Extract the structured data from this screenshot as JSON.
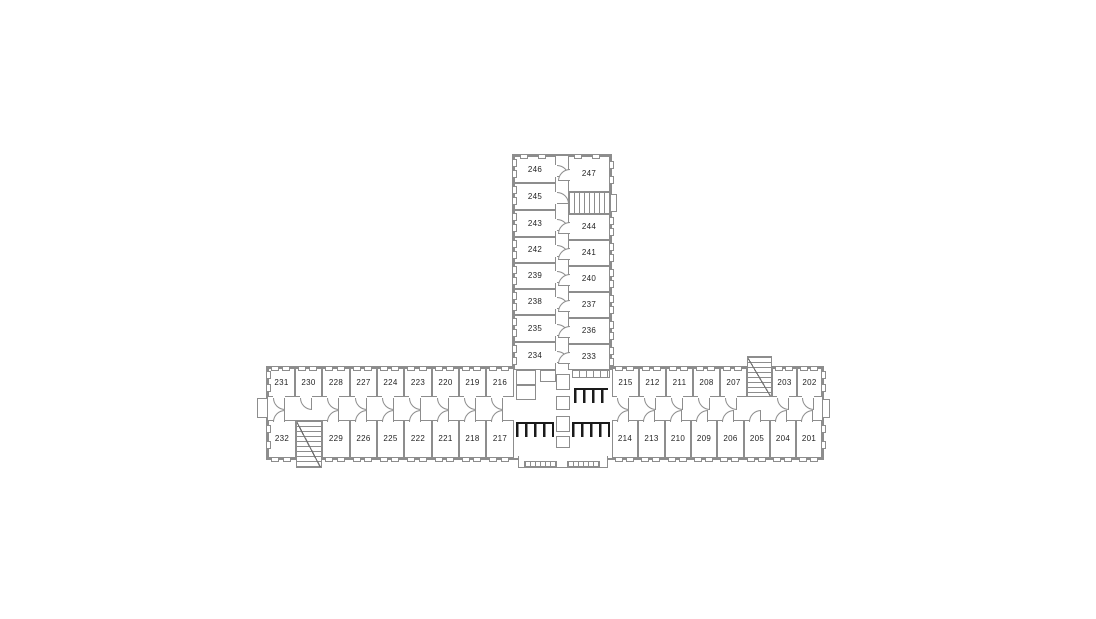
{
  "plan": {
    "canvas": {
      "w": 1096,
      "h": 619
    },
    "colors": {
      "wall": "#8d8d8d",
      "wall_dark": "#6e6e6e",
      "fixture": "#1a1a1a",
      "label": "#1f1f1f",
      "bg": "#ffffff"
    },
    "wings": [
      {
        "name": "main-wing",
        "x": 266,
        "y": 366,
        "w": 558,
        "h": 94,
        "noBottom": false
      },
      {
        "name": "north-wing",
        "x": 512,
        "y": 154,
        "w": 100,
        "h": 216,
        "noBottom": true
      }
    ],
    "rooms": [
      {
        "label": "246",
        "x": 514,
        "y": 156,
        "w": 42,
        "h": 27,
        "win": [
          "w",
          "n"
        ],
        "door": "e"
      },
      {
        "label": "245",
        "x": 514,
        "y": 183,
        "w": 42,
        "h": 27,
        "win": [
          "w"
        ],
        "door": "e"
      },
      {
        "label": "243",
        "x": 514,
        "y": 210,
        "w": 42,
        "h": 27,
        "win": [
          "w"
        ],
        "door": "e"
      },
      {
        "label": "242",
        "x": 514,
        "y": 237,
        "w": 42,
        "h": 26,
        "win": [
          "w"
        ],
        "door": "e"
      },
      {
        "label": "239",
        "x": 514,
        "y": 263,
        "w": 42,
        "h": 26,
        "win": [
          "w"
        ],
        "door": "e"
      },
      {
        "label": "238",
        "x": 514,
        "y": 289,
        "w": 42,
        "h": 26,
        "win": [
          "w"
        ],
        "door": "e"
      },
      {
        "label": "235",
        "x": 514,
        "y": 315,
        "w": 42,
        "h": 27,
        "win": [
          "w"
        ],
        "door": "e"
      },
      {
        "label": "234",
        "x": 514,
        "y": 342,
        "w": 42,
        "h": 28,
        "win": [
          "w"
        ],
        "door": "e"
      },
      {
        "label": "247",
        "x": 568,
        "y": 156,
        "w": 42,
        "h": 36,
        "win": [
          "e",
          "n"
        ],
        "door": "w"
      },
      {
        "label": "244",
        "x": 568,
        "y": 214,
        "w": 42,
        "h": 26,
        "win": [
          "e"
        ],
        "door": "w"
      },
      {
        "label": "241",
        "x": 568,
        "y": 240,
        "w": 42,
        "h": 26,
        "win": [
          "e"
        ],
        "door": "w"
      },
      {
        "label": "240",
        "x": 568,
        "y": 266,
        "w": 42,
        "h": 26,
        "win": [
          "e"
        ],
        "door": "w"
      },
      {
        "label": "237",
        "x": 568,
        "y": 292,
        "w": 42,
        "h": 26,
        "win": [
          "e"
        ],
        "door": "w"
      },
      {
        "label": "236",
        "x": 568,
        "y": 318,
        "w": 42,
        "h": 26,
        "win": [
          "e"
        ],
        "door": "w"
      },
      {
        "label": "233",
        "x": 568,
        "y": 344,
        "w": 42,
        "h": 26,
        "win": [
          "e"
        ],
        "door": "w"
      },
      {
        "label": "231",
        "x": 268,
        "y": 368,
        "w": 27,
        "h": 29,
        "win": [
          "n",
          "w"
        ],
        "door": "s"
      },
      {
        "label": "230",
        "x": 295,
        "y": 368,
        "w": 27,
        "h": 29,
        "win": [
          "n"
        ],
        "door": "s"
      },
      {
        "label": "228",
        "x": 322,
        "y": 368,
        "w": 28,
        "h": 29,
        "win": [
          "n"
        ],
        "door": "s"
      },
      {
        "label": "227",
        "x": 350,
        "y": 368,
        "w": 27,
        "h": 29,
        "win": [
          "n"
        ],
        "door": "s"
      },
      {
        "label": "224",
        "x": 377,
        "y": 368,
        "w": 27,
        "h": 29,
        "win": [
          "n"
        ],
        "door": "s"
      },
      {
        "label": "223",
        "x": 404,
        "y": 368,
        "w": 28,
        "h": 29,
        "win": [
          "n"
        ],
        "door": "s"
      },
      {
        "label": "220",
        "x": 432,
        "y": 368,
        "w": 27,
        "h": 29,
        "win": [
          "n"
        ],
        "door": "s"
      },
      {
        "label": "219",
        "x": 459,
        "y": 368,
        "w": 27,
        "h": 29,
        "win": [
          "n"
        ],
        "door": "s"
      },
      {
        "label": "216",
        "x": 486,
        "y": 368,
        "w": 28,
        "h": 29,
        "win": [
          "n"
        ],
        "door": "s"
      },
      {
        "label": "215",
        "x": 612,
        "y": 368,
        "w": 27,
        "h": 29,
        "win": [
          "n"
        ],
        "door": "s"
      },
      {
        "label": "212",
        "x": 639,
        "y": 368,
        "w": 27,
        "h": 29,
        "win": [
          "n"
        ],
        "door": "s"
      },
      {
        "label": "211",
        "x": 666,
        "y": 368,
        "w": 27,
        "h": 29,
        "win": [
          "n"
        ],
        "door": "s"
      },
      {
        "label": "208",
        "x": 693,
        "y": 368,
        "w": 27,
        "h": 29,
        "win": [
          "n"
        ],
        "door": "s"
      },
      {
        "label": "207",
        "x": 720,
        "y": 368,
        "w": 27,
        "h": 29,
        "win": [
          "n"
        ],
        "door": "s"
      },
      {
        "label": "203",
        "x": 772,
        "y": 368,
        "w": 25,
        "h": 29,
        "win": [
          "n"
        ],
        "door": "s"
      },
      {
        "label": "202",
        "x": 797,
        "y": 368,
        "w": 25,
        "h": 29,
        "win": [
          "n",
          "e"
        ],
        "door": "s"
      },
      {
        "label": "232",
        "x": 268,
        "y": 420,
        "w": 28,
        "h": 38,
        "win": [
          "s",
          "w"
        ],
        "door": "n"
      },
      {
        "label": "229",
        "x": 322,
        "y": 420,
        "w": 28,
        "h": 38,
        "win": [
          "s"
        ],
        "door": "n"
      },
      {
        "label": "226",
        "x": 350,
        "y": 420,
        "w": 27,
        "h": 38,
        "win": [
          "s"
        ],
        "door": "n"
      },
      {
        "label": "225",
        "x": 377,
        "y": 420,
        "w": 27,
        "h": 38,
        "win": [
          "s"
        ],
        "door": "n"
      },
      {
        "label": "222",
        "x": 404,
        "y": 420,
        "w": 28,
        "h": 38,
        "win": [
          "s"
        ],
        "door": "n"
      },
      {
        "label": "221",
        "x": 432,
        "y": 420,
        "w": 27,
        "h": 38,
        "win": [
          "s"
        ],
        "door": "n"
      },
      {
        "label": "218",
        "x": 459,
        "y": 420,
        "w": 27,
        "h": 38,
        "win": [
          "s"
        ],
        "door": "n"
      },
      {
        "label": "217",
        "x": 486,
        "y": 420,
        "w": 28,
        "h": 38,
        "win": [
          "s"
        ],
        "door": "n"
      },
      {
        "label": "214",
        "x": 612,
        "y": 420,
        "w": 26,
        "h": 38,
        "win": [
          "s"
        ],
        "door": "n"
      },
      {
        "label": "213",
        "x": 638,
        "y": 420,
        "w": 27,
        "h": 38,
        "win": [
          "s"
        ],
        "door": "n"
      },
      {
        "label": "210",
        "x": 665,
        "y": 420,
        "w": 26,
        "h": 38,
        "win": [
          "s"
        ],
        "door": "n"
      },
      {
        "label": "209",
        "x": 691,
        "y": 420,
        "w": 26,
        "h": 38,
        "win": [
          "s"
        ],
        "door": "n"
      },
      {
        "label": "206",
        "x": 717,
        "y": 420,
        "w": 27,
        "h": 38,
        "win": [
          "s"
        ],
        "door": "n"
      },
      {
        "label": "205",
        "x": 744,
        "y": 420,
        "w": 26,
        "h": 38,
        "win": [
          "s"
        ],
        "door": "n"
      },
      {
        "label": "204",
        "x": 770,
        "y": 420,
        "w": 26,
        "h": 38,
        "win": [
          "s"
        ],
        "door": "n"
      },
      {
        "label": "201",
        "x": 796,
        "y": 420,
        "w": 26,
        "h": 38,
        "win": [
          "s",
          "e"
        ],
        "door": "n"
      }
    ],
    "features": [
      {
        "type": "stair",
        "name": "stair-north-wing",
        "x": 568,
        "y": 192,
        "w": 42,
        "h": 22,
        "flight": "h"
      },
      {
        "type": "bump",
        "name": "stair-north-wing-landing",
        "x": 610,
        "y": 194,
        "w": 7,
        "h": 18
      },
      {
        "type": "stair",
        "name": "stair-southwest",
        "x": 296,
        "y": 420,
        "w": 26,
        "h": 48,
        "flight": "v"
      },
      {
        "type": "stair",
        "name": "stair-northeast",
        "x": 747,
        "y": 356,
        "w": 25,
        "h": 41,
        "flight": "v"
      },
      {
        "type": "cell",
        "name": "core-closet-a",
        "x": 516,
        "y": 370,
        "w": 20,
        "h": 15
      },
      {
        "type": "cell",
        "name": "core-closet-b",
        "x": 516,
        "y": 385,
        "w": 20,
        "h": 15
      },
      {
        "type": "cell",
        "name": "core-closet-c",
        "x": 540,
        "y": 370,
        "w": 16,
        "h": 12
      },
      {
        "type": "cell",
        "name": "core-shaft-1",
        "x": 556,
        "y": 374,
        "w": 14,
        "h": 16
      },
      {
        "type": "cell",
        "name": "core-shaft-2",
        "x": 556,
        "y": 396,
        "w": 14,
        "h": 14
      },
      {
        "type": "cell",
        "name": "core-shaft-3",
        "x": 556,
        "y": 416,
        "w": 14,
        "h": 16
      },
      {
        "type": "cell",
        "name": "core-shaft-4",
        "x": 556,
        "y": 436,
        "w": 14,
        "h": 12
      },
      {
        "type": "sinks",
        "name": "bathroom-sinks-ne",
        "x": 572,
        "y": 370,
        "w": 38,
        "h": 8
      },
      {
        "type": "stalls",
        "name": "bathroom-stalls-ne",
        "x": 574,
        "y": 388,
        "w": 34,
        "h": 15
      },
      {
        "type": "stalls",
        "name": "bathroom-stalls-sw",
        "x": 516,
        "y": 422,
        "w": 38,
        "h": 15
      },
      {
        "type": "stalls",
        "name": "bathroom-stalls-se",
        "x": 572,
        "y": 422,
        "w": 38,
        "h": 15
      },
      {
        "type": "porch",
        "name": "entrance-porch",
        "x": 518,
        "y": 456,
        "w": 90,
        "h": 12
      },
      {
        "type": "cols",
        "name": "porch-columns-left",
        "x": 524,
        "y": 461,
        "w": 33,
        "h": 6
      },
      {
        "type": "cols",
        "name": "porch-columns-right",
        "x": 567,
        "y": 461,
        "w": 33,
        "h": 6
      },
      {
        "type": "cell",
        "name": "west-vestibule",
        "x": 257,
        "y": 398,
        "w": 11,
        "h": 20
      },
      {
        "type": "cell",
        "name": "east-vestibule",
        "x": 822,
        "y": 399,
        "w": 8,
        "h": 19
      }
    ]
  }
}
